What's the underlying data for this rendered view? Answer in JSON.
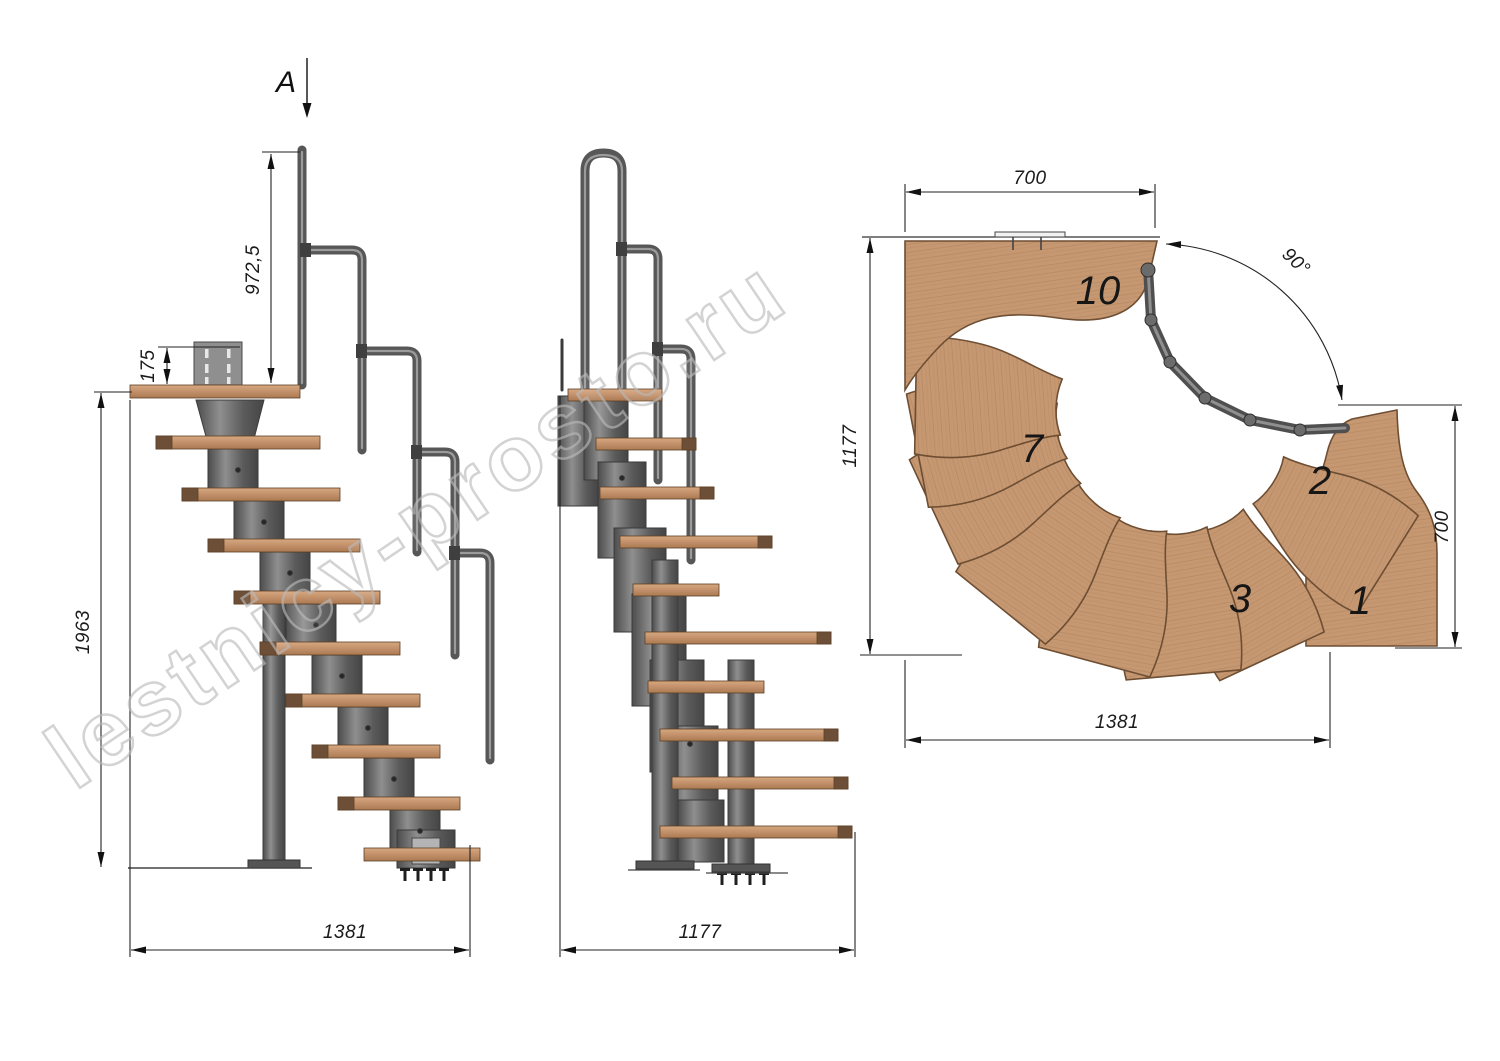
{
  "watermark": "lestnicy-prosto.ru",
  "section_label": "A",
  "side_view": {
    "dim_rail_height": "972,5",
    "dim_plate_height": "175",
    "dim_total_height": "1963",
    "dim_length": "1381"
  },
  "front_view": {
    "dim_width": "1177"
  },
  "plan_view": {
    "dim_top_width": "700",
    "dim_left_depth": "1177",
    "dim_right_depth": "700",
    "dim_bottom_length": "1381",
    "dim_turn_angle": "90°",
    "tread_labels": {
      "t10": "10",
      "t7": "7",
      "t2": "2",
      "t3": "3",
      "t1": "1"
    }
  },
  "colors": {
    "wood": "#c59872",
    "wood_dark_cap": "#6d4f37",
    "metal": "#6a6a6a",
    "line": "#222222",
    "watermark_stroke": "#bababa"
  }
}
